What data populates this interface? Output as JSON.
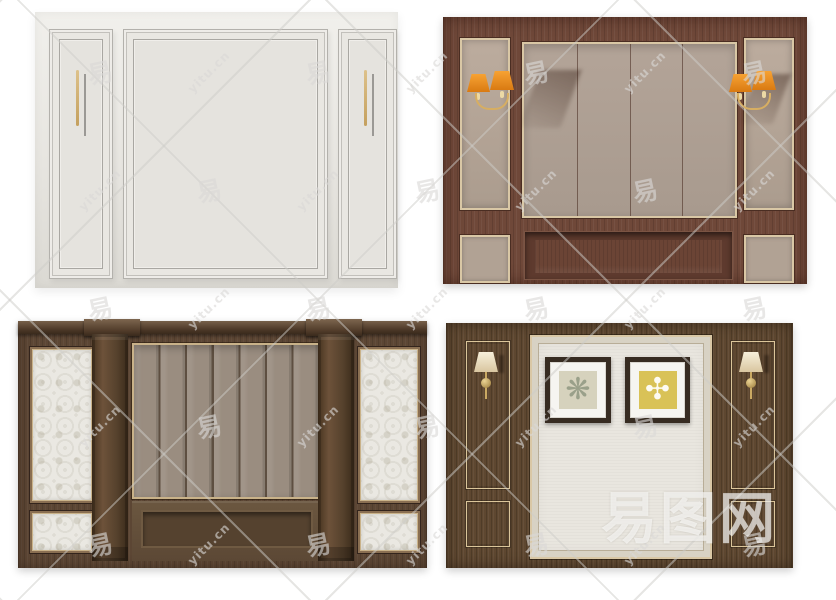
{
  "watermark": {
    "tile_char": "易",
    "tile_url": "yitu.cn",
    "brand": "易图网",
    "grid": {
      "x0": 100,
      "y0": 72,
      "dx": 109,
      "dy": 118,
      "cols": 7,
      "rows": 5
    }
  },
  "artworks": [
    {
      "glyph": "❋",
      "style": "sage-damask-on-cream"
    },
    {
      "glyph": "✣",
      "style": "white-cross-on-yellow"
    }
  ],
  "palette": {
    "wood_red": "#6F4839",
    "wood_red_dark": "#4a2d22",
    "wood_walnut": "#5C4634",
    "wood_brown": "#5E4730",
    "panel_white": "#e7e5e0",
    "panel_taupe": "#ad9f93",
    "slat_taupe": "#9a8d80",
    "trim_gold": "#d9c7a5",
    "lamp_orange": "#e8821a",
    "lamp_cream": "#efe3c8",
    "fabric_cream": "#e9e6df",
    "damask_white": "#eae8e2",
    "art_yellow": "#d9c257",
    "art_sage": "#d6d2bd",
    "frame_dark": "#372c22"
  }
}
